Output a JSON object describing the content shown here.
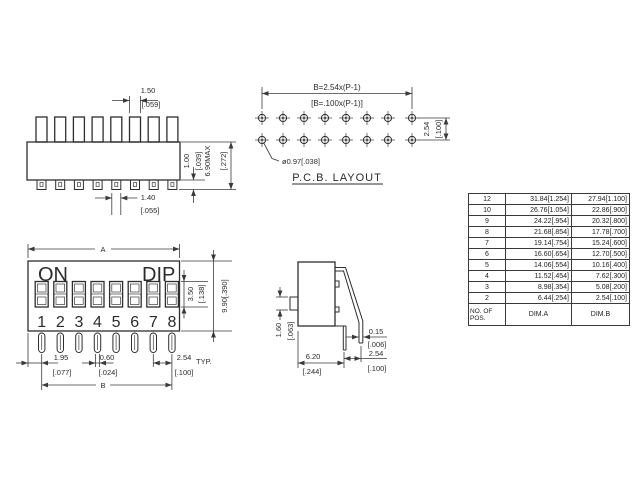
{
  "colors": {
    "background": "#ffffff",
    "line": "#2e2e2e",
    "text": "#2b2b2b"
  },
  "views": {
    "side_elevation": {
      "actuator_width_mm": "1.50",
      "actuator_width_in": "[.059]",
      "pin_protrusion_mm": "1.00",
      "pin_protrusion_in": "[.039]",
      "overall_height_mm": "6.90MAX",
      "overall_height_in": "[.272]",
      "pin_width_mm": "1.40",
      "pin_width_in": "[.055]"
    },
    "pcb_layout": {
      "title": "P.C.B.  LAYOUT",
      "span_formula_mm": "B=2.54x(P-1)",
      "span_formula_in": "[B=.100x(P-1)]",
      "row_pitch_mm": "2.54",
      "row_pitch_in": "[.100]",
      "hole_diameter": "ø0.97[.038]"
    },
    "front_view": {
      "label_on": "ON",
      "label_dip": "DIP",
      "positions": [
        "1",
        "2",
        "3",
        "4",
        "5",
        "6",
        "7",
        "8"
      ],
      "dim_a_label": "A",
      "dim_b_label": "B",
      "window_height_mm": "3.50",
      "window_height_in": "[.138]",
      "body_height": "9.90[.390]",
      "end_offset_mm": "1.95",
      "end_offset_in": "[.077]",
      "pin_width_mm": "0.60",
      "pin_width_in": "[.024]",
      "pin_pitch_mm": "2.54",
      "pin_pitch_in": "[.100]",
      "typ_label": "TYP."
    },
    "side_view": {
      "actuator_height_mm": "1.60",
      "actuator_height_in": "[.063]",
      "body_depth_mm": "6.20",
      "body_depth_in": "[.244]",
      "pin_thickness_mm": "0.15",
      "pin_thickness_in": "[.006]",
      "lead_spacing_mm": "2.54",
      "lead_spacing_in": "[.100]"
    }
  },
  "table": {
    "footer": {
      "pos_line1": "NO. OF",
      "pos_line2": "POS.",
      "dim_a": "DIM.A",
      "dim_b": "DIM.B"
    },
    "rows": [
      [
        "12",
        "31.84[1.254]",
        "27.94[1.100]"
      ],
      [
        "10",
        "26.76[1.054]",
        "22.86[.900]"
      ],
      [
        "9",
        "24.22[.954]",
        "20.32[.800]"
      ],
      [
        "8",
        "21.68[.854]",
        "17.78[.700]"
      ],
      [
        "7",
        "19.14[.754]",
        "15.24[.600]"
      ],
      [
        "6",
        "16.60[.654]",
        "12.70[.500]"
      ],
      [
        "5",
        "14.06[.554]",
        "10.16[.400]"
      ],
      [
        "4",
        "11.52[.454]",
        "7.62[.300]"
      ],
      [
        "3",
        "8.98[.354]",
        "5.08[.200]"
      ],
      [
        "2",
        "6.44[.254]",
        "2.54[.100]"
      ]
    ]
  }
}
